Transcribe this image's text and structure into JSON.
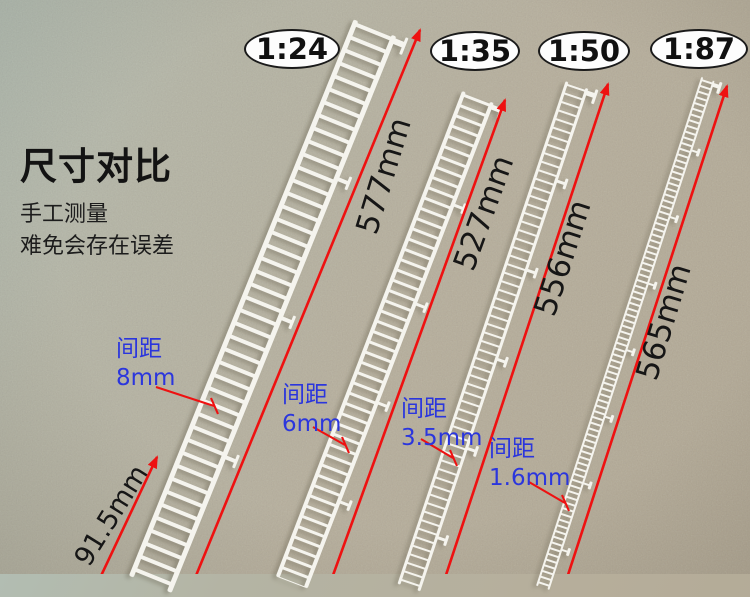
{
  "title": "尺寸对比",
  "note_line1": "手工测量",
  "note_line2": "难免会存在误差",
  "colors": {
    "red": "#ee1111",
    "blue": "#2b36dd",
    "ladderwhite": "#f5f4ee"
  },
  "scales": [
    {
      "ratio": "1:24",
      "total_length": "577mm",
      "spacing_title": "间距",
      "spacing_value": "8mm"
    },
    {
      "ratio": "1:35",
      "total_length": "527mm",
      "spacing_title": "间距",
      "spacing_value": "6mm"
    },
    {
      "ratio": "1:50",
      "total_length": "556mm",
      "spacing_title": "间距",
      "spacing_value": "3.5mm"
    },
    {
      "ratio": "1:87",
      "total_length": "565mm",
      "spacing_title": "间距",
      "spacing_value": "1.6mm"
    }
  ],
  "bottom_width_label": "91.5mm"
}
